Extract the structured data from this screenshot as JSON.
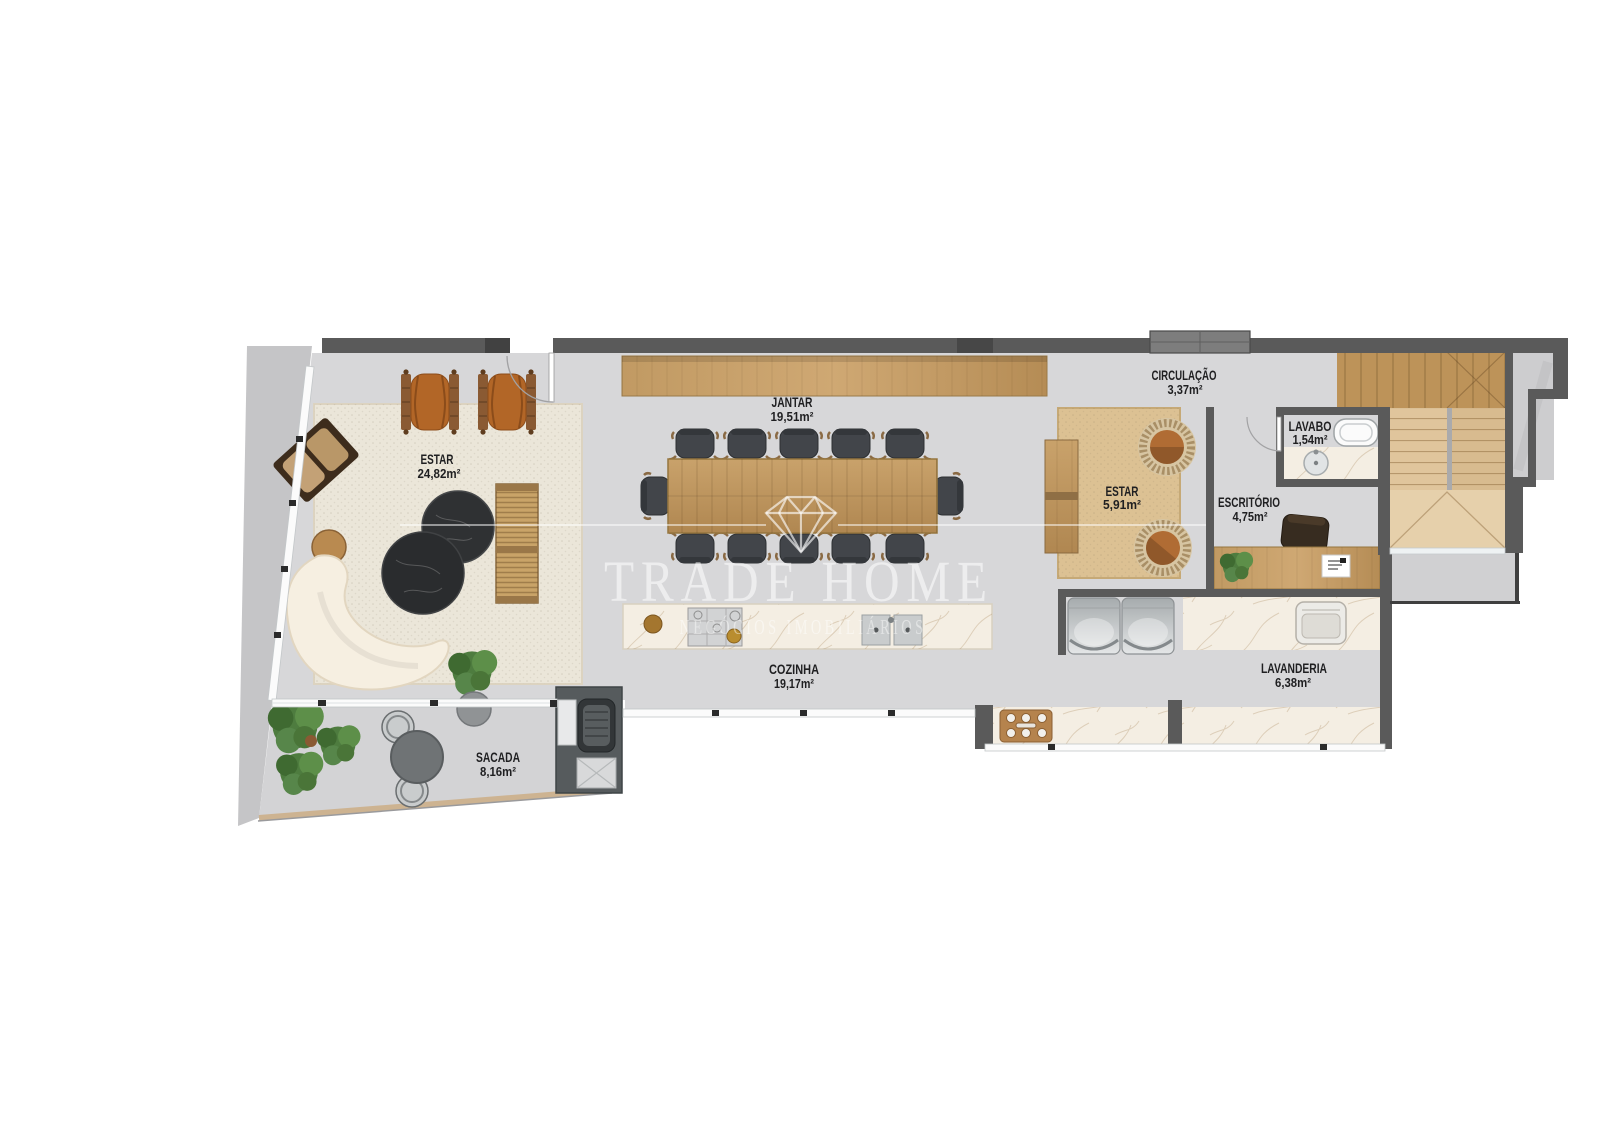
{
  "watermark": {
    "brand": "TRADE HOME",
    "tagline": "NEGÓCIOS IMOBILIÁRIOS",
    "icon": "diamond-icon",
    "color": "#ffffff"
  },
  "rooms": [
    {
      "id": "estar-living",
      "label": "ESTAR",
      "area": "24,82m²"
    },
    {
      "id": "jantar",
      "label": "JANTAR",
      "area": "19,51m²"
    },
    {
      "id": "cozinha",
      "label": "COZINHA",
      "area": "19,17m²"
    },
    {
      "id": "circulacao",
      "label": "CIRCULAÇÃO",
      "area": "3,37m²"
    },
    {
      "id": "lavabo",
      "label": "LAVABO",
      "area": "1,54m²"
    },
    {
      "id": "estar-intimo",
      "label": "ESTAR",
      "area": "5,91m²"
    },
    {
      "id": "escritorio",
      "label": "ESCRITÓRIO",
      "area": "4,75m²"
    },
    {
      "id": "lavanderia",
      "label": "LAVANDERIA",
      "area": "6,38m²"
    },
    {
      "id": "sacada",
      "label": "SACADA",
      "area": "8,16m²"
    }
  ],
  "palette": {
    "wall": "#5a5a5a",
    "floor": "#d7d7d9",
    "terrace": "#c5c5c7",
    "balcony": "#d3d3d5",
    "wood": "#c49a62",
    "wood_light": "#e0c59c",
    "marble": "#f4eee3",
    "rug_cream": "#ebe6d9",
    "rug_tan": "#dcc193",
    "leather": "#b26627",
    "chair_dark": "#414447",
    "appliance": "#c9ccce",
    "plant": "#4e7c3f",
    "label_text": "#1f1f21"
  }
}
